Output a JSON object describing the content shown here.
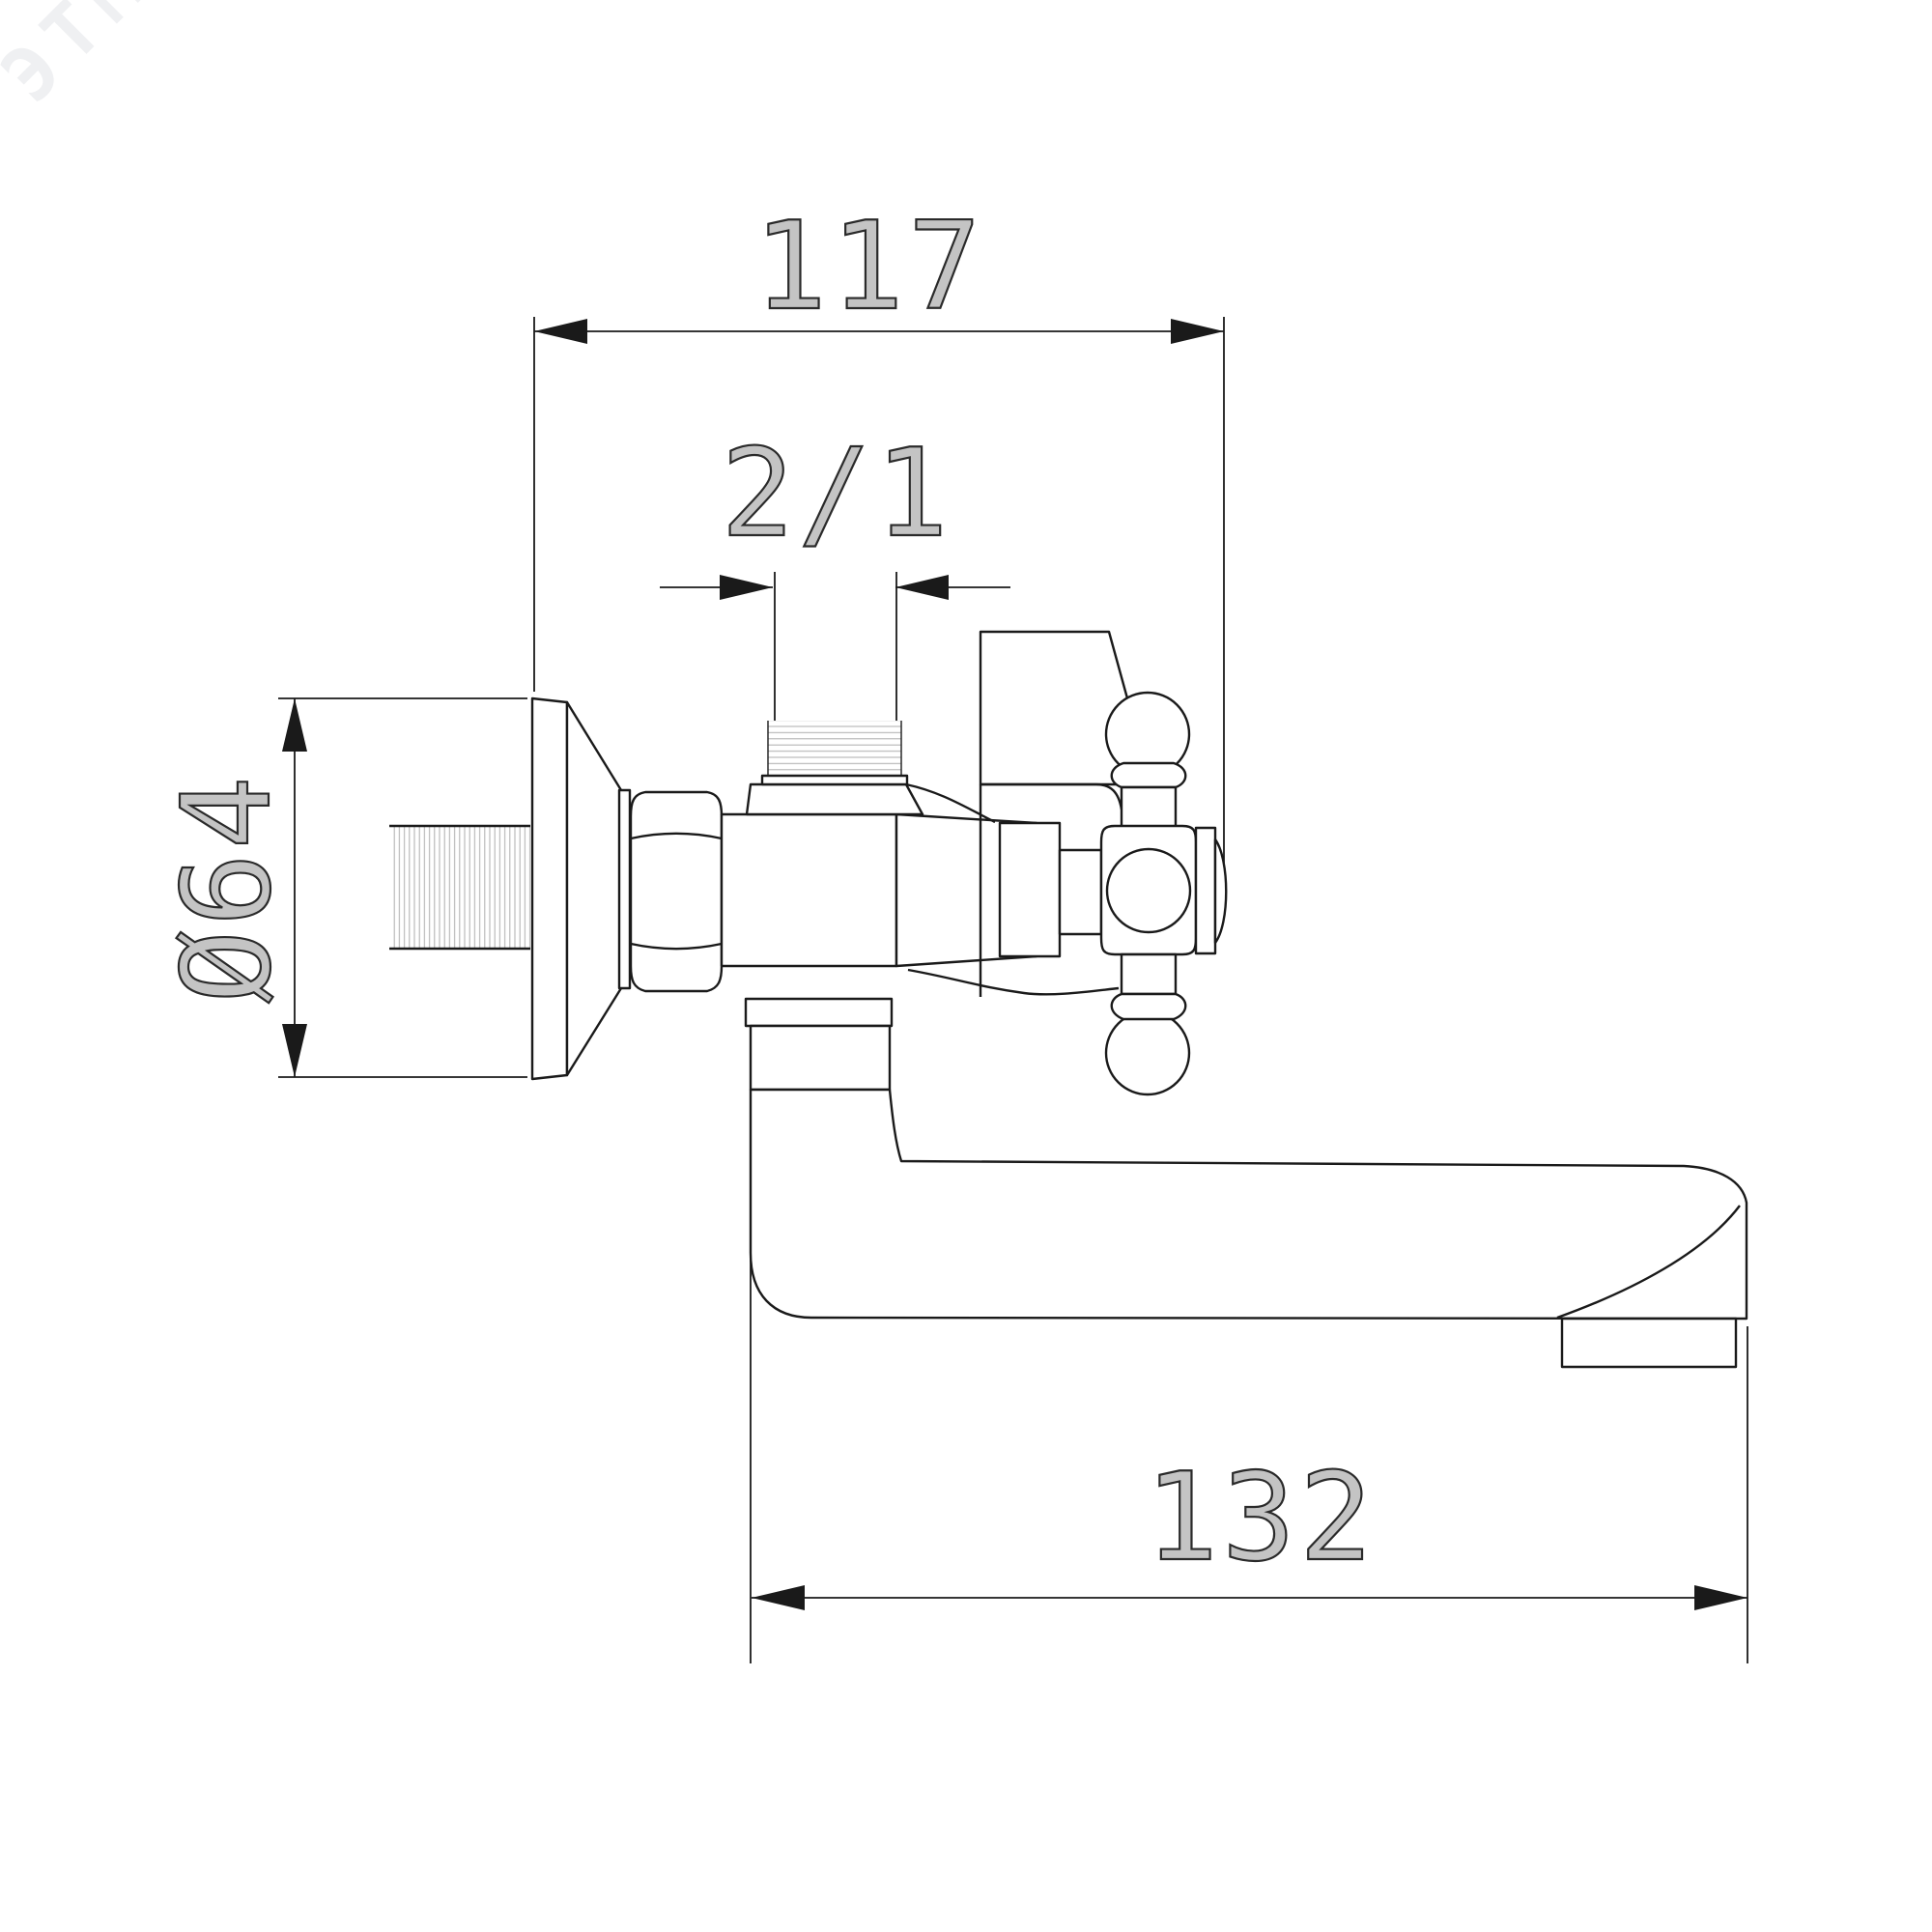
{
  "document": {
    "type": "technical-dimension-drawing",
    "subject": "wall-mounted bath faucet with cross handle and tub spout, side view"
  },
  "watermark": {
    "text": "ЭТМ"
  },
  "dimensions": {
    "top_width": {
      "value": "117",
      "meaning": "overall depth from wall flange to handle end"
    },
    "top_thread": {
      "value": "2/1",
      "meaning": "top shower-port thread size"
    },
    "left_diameter": {
      "value": "Ø64",
      "meaning": "wall escutcheon diameter"
    },
    "spout_length": {
      "value": "132",
      "meaning": "spout projection length"
    }
  },
  "colors": {
    "background": "#ffffff",
    "line": "#1a1a1a",
    "thread": "#b4b4b4",
    "dim_text": "#2a2a2a",
    "watermark": "#78828f"
  }
}
